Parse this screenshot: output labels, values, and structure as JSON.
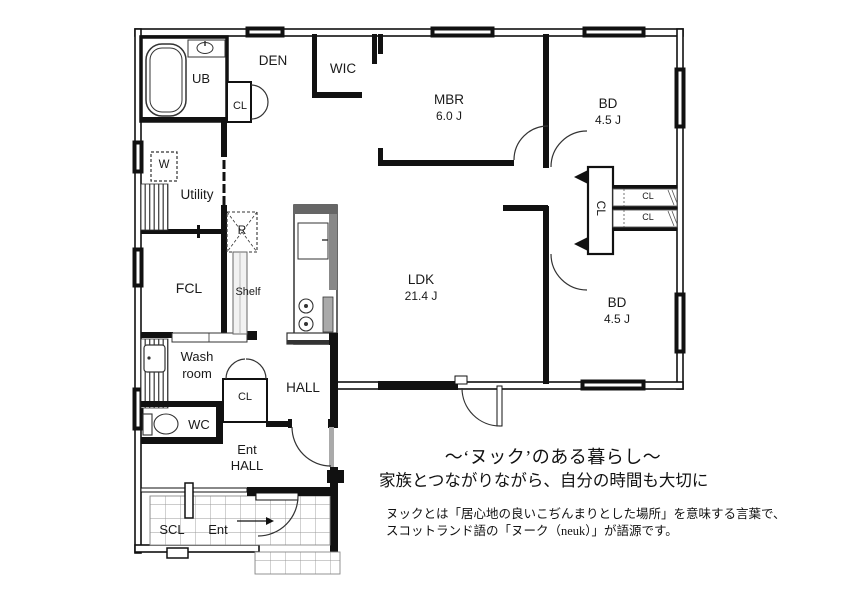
{
  "rooms": {
    "ub": "UB",
    "den": "DEN",
    "wic": "WIC",
    "mbr": {
      "name": "MBR",
      "size": "6.0 J"
    },
    "bd_upper": {
      "name": "BD",
      "size": "4.5 J"
    },
    "bd_lower": {
      "name": "BD",
      "size": "4.5 J"
    },
    "ldk": {
      "name": "LDK",
      "size": "21.4 J"
    },
    "utility": "Utility",
    "fcl": "FCL",
    "shelf": "Shelf",
    "washroom": {
      "line1": "Wash",
      "line2": "room"
    },
    "wc": "WC",
    "hall": "HALL",
    "ent_hall": {
      "line1": "Ent",
      "line2": "HALL"
    },
    "scl": "SCL",
    "ent": "Ent"
  },
  "closets": {
    "den_cl": "CL",
    "hall_cl": "CL",
    "nook_cl": "CL",
    "bd_upper_cl": "CL",
    "bd_lower_cl": "CL"
  },
  "appliances": {
    "washer": "W",
    "refrigerator": "R"
  },
  "caption": {
    "title": "～‘ヌック’のある暮らし～",
    "subtitle": "家族とつながりながら、自分の時間も大切に",
    "body_line1": "ヌックとは「居心地の良いこぢんまりとした場所」を意味する言葉で、",
    "body_line2": "スコットランド語の「ヌーク（neuk）」が語源です。"
  },
  "colors": {
    "wall": "#111111",
    "line": "#333333",
    "tile_grid": "#999999",
    "background": "#ffffff"
  }
}
